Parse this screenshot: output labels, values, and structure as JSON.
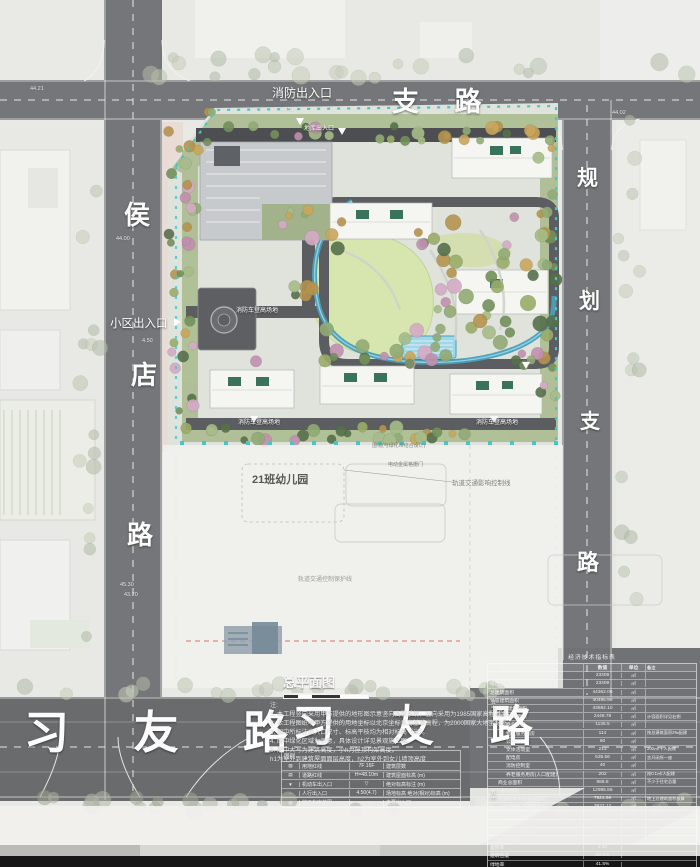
{
  "roads": {
    "top": "支  路",
    "left_chars": [
      "侯",
      "店",
      "路"
    ],
    "right_chars": [
      "规",
      "划",
      "支",
      "路"
    ],
    "bottom_left": "习 友 路",
    "bottom_right": "习  友  路"
  },
  "labels": {
    "fire_exit": "消防出入口",
    "community_entrance": "小区出入口",
    "garage_entrance": "地库出入口",
    "fire_lane_1": "消防车登高场地",
    "fire_lane_2": "消防车登高场地",
    "fire_lane_3": "消防车登高场地",
    "kindergarten": "21班幼儿园",
    "rail_control": "轨道交通影响控制线",
    "rail_protect": "轨道交通控制保护线",
    "fence": "围墙(与绿化带结合设计)",
    "gate": "电动金属格栅门"
  },
  "plan": {
    "title": "总平面图",
    "notes_heading": "注:",
    "notes": [
      "1. 本工程竖向采用甲方提供的地形图示意竖向高程系统，竖向采用为1985国家高程基准。",
      "2. 本工程图纸中甲方提供的用地坐标以北京坐标系为基准高程，为2000国家大地坐标系。",
      "3. 图中所标注出入口尺寸、标高平枝均为相对标高（米）。",
      "4. 图中绿化区域为示意，具体设计详见景观施工图。",
      "5. 图中大写为建筑高度，小h为屋顶构架高度。",
      "h1为室外到建筑屋面面层高度，h2为室外到女儿墙顶高度"
    ]
  },
  "legend": {
    "title": "图例",
    "rows": [
      {
        "pat": "▧",
        "l1": "用地红线",
        "sym": "7F  16F",
        "l2": "建筑层数"
      },
      {
        "pat": "▤",
        "l1": "道路红线",
        "sym": "H=48.10m",
        "l2": "建筑屋面标高 (m)"
      },
      {
        "pat": "▼",
        "l1": "机动车出入口",
        "sym": "▽",
        "l2": "绝对标高标注 (m)"
      },
      {
        "pat": "∙∙∙",
        "l1": "人行出入口",
        "sym": "4.50(4.7)",
        "l2": "场地标高 绝对(相对)标高 (m)"
      },
      {
        "pat": "▨",
        "l1": "地下车库范围",
        "sym": "⊏ ⊐",
        "l2": "主要出入口"
      }
    ]
  },
  "indicators": {
    "title": "经济技术指标表",
    "header": [
      "项目",
      "数值",
      "单位",
      "备注"
    ],
    "group_marker": "其中",
    "rows": [
      {
        "label": "规划用地面积",
        "val": "23309",
        "unit": "㎡",
        "rem": "",
        "indent": 0
      },
      {
        "label": "可出让用地面积",
        "val": "23309",
        "unit": "㎡",
        "rem": "",
        "indent": 0
      },
      {
        "label": "总建筑面积",
        "val": "44362.06",
        "unit": "㎡",
        "rem": "",
        "indent": 0
      },
      {
        "label": "计容建筑面积",
        "val": "40495.99",
        "unit": "㎡",
        "rem": "",
        "indent": 0
      },
      {
        "label": "住宅建筑面积",
        "val": "43582.10",
        "unit": "㎡",
        "rem": "",
        "indent": 1
      },
      {
        "label": "配套建筑面积",
        "val": "2448.78",
        "unit": "㎡",
        "rem": "计容面积详见右侧",
        "indent": 1
      },
      {
        "label": "商业配套",
        "val": "1135.5",
        "unit": "㎡",
        "rem": "",
        "indent": 2
      },
      {
        "label": "物业服务用房",
        "val": "114",
        "unit": "㎡",
        "rem": "按总建筑面积2‰配建",
        "indent": 2
      },
      {
        "label": "公厕",
        "val": "60",
        "unit": "㎡",
        "rem": "",
        "indent": 2
      },
      {
        "label": "文体活动室",
        "val": "213",
        "unit": "㎡",
        "rem": "200㎡/千人配建",
        "indent": 2
      },
      {
        "label": "配电房",
        "val": "535.56",
        "unit": "㎡",
        "rem": "含开闭所一座",
        "indent": 2
      },
      {
        "label": "消防控制室",
        "val": "40",
        "unit": "㎡",
        "rem": "",
        "indent": 2
      },
      {
        "label": "养老服务用房(人口配建)",
        "val": "202",
        "unit": "㎡",
        "rem": "按0.1㎡/人配建",
        "indent": 2
      },
      {
        "label": "商业总面积",
        "val": "988.8",
        "unit": "㎡",
        "rem": "不少于住宅总量",
        "indent": 1
      },
      {
        "label": "地下建筑面积",
        "val": "12995.56",
        "unit": "㎡",
        "rem": "",
        "indent": 0
      },
      {
        "label": "普通机动车停车库面积",
        "val": "7924.96",
        "unit": "㎡",
        "rem": "地上总建筑面积核算",
        "indent": 1
      },
      {
        "label": "人防机动车停车库面积",
        "val": "3937.12",
        "unit": "㎡",
        "rem": "",
        "indent": 1
      },
      {
        "label": "非机动车库面积",
        "val": "748.4",
        "unit": "㎡",
        "rem": "",
        "indent": 1
      },
      {
        "label": "设备用房面积",
        "val": "1452.72",
        "unit": "㎡",
        "rem": "",
        "indent": 1
      },
      {
        "label": "门卫及其他面积",
        "val": "287.78",
        "unit": "㎡",
        "rem": "",
        "indent": 1
      },
      {
        "label": "架空层面积",
        "val": "1474.06",
        "unit": "㎡",
        "rem": "",
        "indent": 1
      },
      {
        "label": "容积率",
        "val": "2.20",
        "unit": "",
        "rem": "",
        "indent": 0
      },
      {
        "label": "建筑密度",
        "val": "20.0%",
        "unit": "",
        "rem": "",
        "indent": 0
      },
      {
        "label": "绿地率",
        "val": "41.5%",
        "unit": "",
        "rem": "",
        "indent": 0
      }
    ]
  },
  "dims": [
    {
      "x": 30,
      "y": 86,
      "t": "44.21"
    },
    {
      "x": 280,
      "y": 107,
      "t": "44.51"
    },
    {
      "x": 448,
      "y": 110,
      "t": "44.63"
    },
    {
      "x": 612,
      "y": 110,
      "t": "44.02"
    },
    {
      "x": 116,
      "y": 236,
      "t": "44.00"
    },
    {
      "x": 142,
      "y": 338,
      "t": "4.50"
    },
    {
      "x": 120,
      "y": 582,
      "t": "45.30"
    },
    {
      "x": 124,
      "y": 592,
      "t": "43.20"
    }
  ]
}
